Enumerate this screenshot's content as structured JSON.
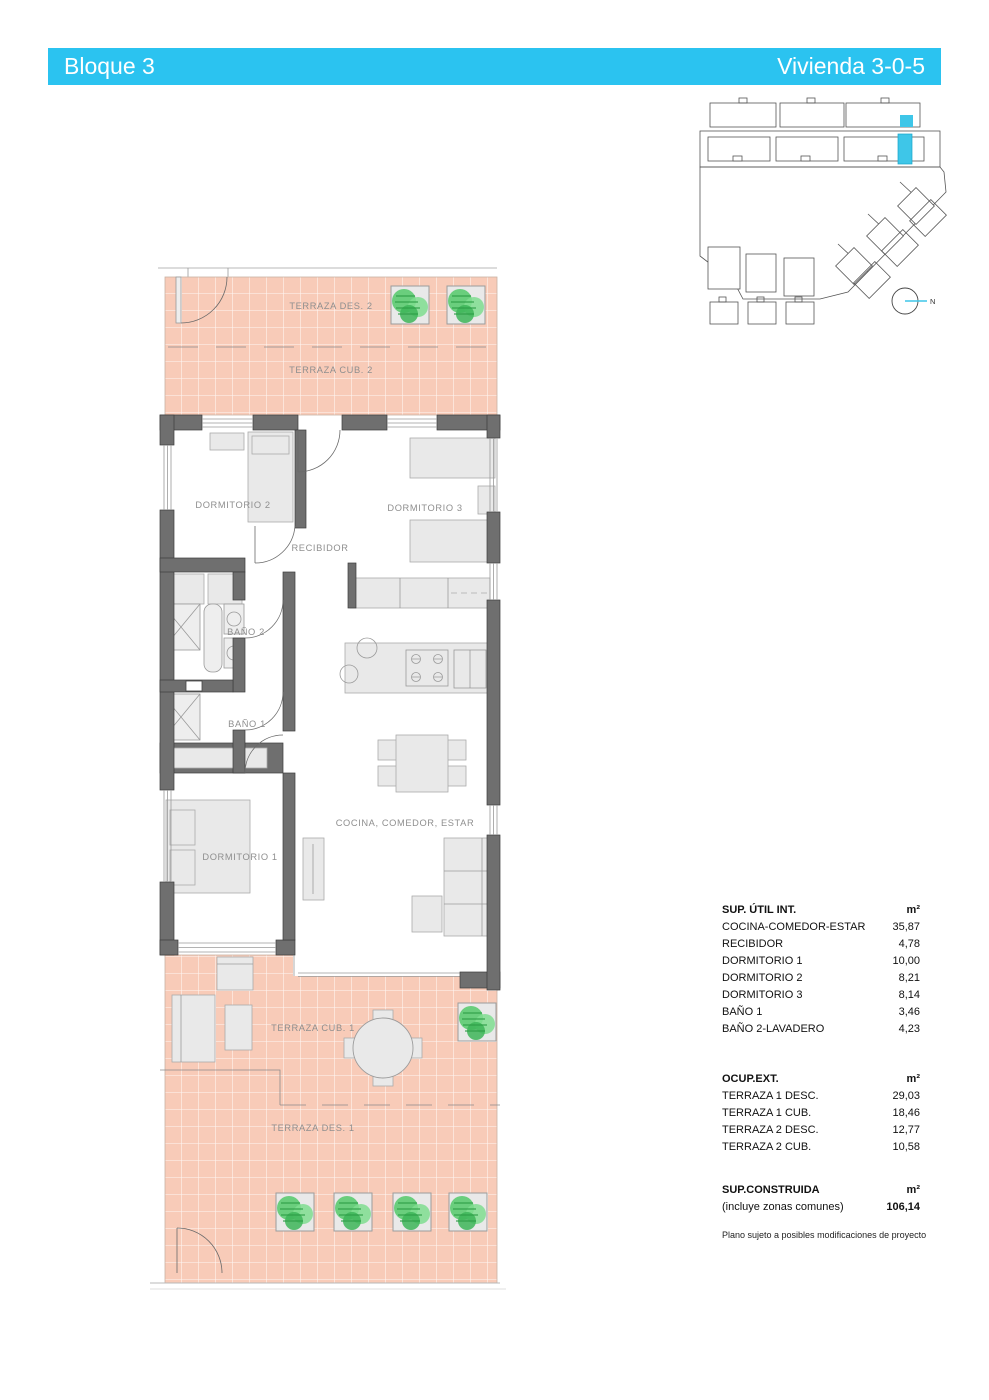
{
  "header": {
    "left": "Bloque 3",
    "right": "Vivienda 3-0-5",
    "bg_color": "#2BC3F0",
    "text_color": "#FFFFFF"
  },
  "colors": {
    "terrace_fill": "#F8CBB8",
    "terrace_grid": "#FFFFFF",
    "wall_gray": "#6F6F6F",
    "furniture_gray": "#E9E9E9",
    "plant_green": "#54C96A",
    "highlight_cyan": "#3EC6E8",
    "label_gray": "#8F8F8F"
  },
  "floorplan": {
    "rooms": {
      "terraza_des_2": "TERRAZA DES. 2",
      "terraza_cub_2": "TERRAZA CUB. 2",
      "dormitorio_2": "DORMITORIO 2",
      "dormitorio_3": "DORMITORIO 3",
      "recibidor": "RECIBIDOR",
      "bano_2": "BAÑO 2",
      "bano_1": "BAÑO 1",
      "dormitorio_1": "DORMITORIO 1",
      "cocina_comedor_estar": "COCINA, COMEDOR, ESTAR",
      "terraza_cub_1": "TERRAZA CUB. 1",
      "terraza_des_1": "TERRAZA DES. 1"
    }
  },
  "site_plan": {
    "north_label": "N"
  },
  "area_table": {
    "sections": [
      {
        "title": "SUP. ÚTIL INT.",
        "unit": "m²",
        "rows": [
          [
            "COCINA-COMEDOR-ESTAR",
            "35,87"
          ],
          [
            "RECIBIDOR",
            "4,78"
          ],
          [
            "DORMITORIO 1",
            "10,00"
          ],
          [
            "DORMITORIO 2",
            "8,21"
          ],
          [
            "DORMITORIO 3",
            "8,14"
          ],
          [
            "BAÑO 1",
            "3,46"
          ],
          [
            "BAÑO 2-LAVADERO",
            "4,23"
          ]
        ]
      },
      {
        "title": "OCUP.EXT.",
        "unit": "m²",
        "rows": [
          [
            "TERRAZA 1 DESC.",
            "29,03"
          ],
          [
            "TERRAZA 1 CUB.",
            "18,46"
          ],
          [
            "TERRAZA 2 DESC.",
            "12,77"
          ],
          [
            "TERRAZA 2 CUB.",
            "10,58"
          ]
        ]
      },
      {
        "title": "SUP.CONSTRUIDA",
        "unit": "m²",
        "rows": [
          [
            "(incluye zonas comunes)",
            "106,14"
          ]
        ]
      }
    ]
  },
  "footnote": "Plano sujeto a posibles modificaciones de proyecto"
}
